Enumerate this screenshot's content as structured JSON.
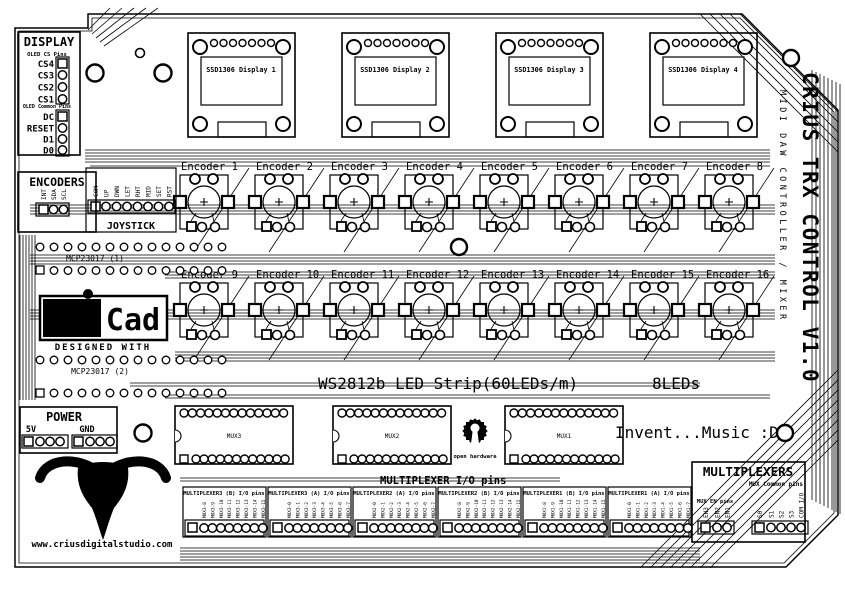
{
  "board": {
    "title_vertical": "CRIUS TRX CONTROL V1.0",
    "subtitle_vertical": "MIDI DAW CONTROLLER / MIXER",
    "website": "www.criusdigitalstudio.com",
    "slogan": "Invent...Music :D",
    "led_strip_label": "WS2812b LED Strip(60LEDs/m)",
    "led_count_label": "8LEDs",
    "skull_text": "CRIUS"
  },
  "display_block": {
    "title": "DISPLAY",
    "cs_section": "OLED CS Pins",
    "cs_pins": [
      "CS4",
      "CS3",
      "CS2",
      "CS1"
    ],
    "common_section": "OLED Common Pins",
    "common_pins": [
      "DC",
      "RESET",
      "D1",
      "D0"
    ]
  },
  "displays": [
    "SSD1306 Display 1",
    "SSD1306 Display 2",
    "SSD1306 Display 3",
    "SSD1306 Display 4"
  ],
  "encoders_block": {
    "title": "ENCODERS",
    "pins": [
      "INT",
      "SDA",
      "SCL"
    ]
  },
  "joystick": {
    "title": "JOYSTICK",
    "pins": [
      "COM",
      "UP",
      "DWN",
      "LET",
      "RHT",
      "MID",
      "SET",
      "RST"
    ]
  },
  "expanders": [
    "MCP23017 (1)",
    "MCP23017 (2)"
  ],
  "kicad": {
    "logo_left": "Ki",
    "logo_right": "Cad",
    "tagline": "DESIGNED WITH"
  },
  "encoders": [
    "Encoder 1",
    "Encoder 2",
    "Encoder 3",
    "Encoder 4",
    "Encoder 5",
    "Encoder 6",
    "Encoder 7",
    "Encoder 8",
    "Encoder 9",
    "Encoder 10",
    "Encoder 11",
    "Encoder 12",
    "Encoder 13",
    "Encoder 14",
    "Encoder 15",
    "Encoder 16"
  ],
  "power": {
    "title": "POWER",
    "pins": [
      "5V",
      "GND"
    ]
  },
  "mux_chips": [
    "MUX3",
    "MUX2",
    "MUX1"
  ],
  "mux_io_title": "MULTIPLEXER I/O pins",
  "mux_groups": [
    {
      "title": "MULTIPLEXER3 (B) I/O pins",
      "pins": [
        "MUX3-8",
        "MUX3-9",
        "MUX3-10",
        "MUX3-11",
        "MUX3-12",
        "MUX3-13",
        "MUX3-14",
        "MUX3-15"
      ]
    },
    {
      "title": "MULTIPLEXER3 (A) I/O pins",
      "pins": [
        "MUX3-0",
        "MUX3-1",
        "MUX3-2",
        "MUX3-3",
        "MUX3-4",
        "MUX3-5",
        "MUX3-6",
        "MUX3-7"
      ]
    },
    {
      "title": "MULTIPLEXER2 (A) I/O pins",
      "pins": [
        "MUX2-0",
        "MUX2-1",
        "MUX2-2",
        "MUX2-3",
        "MUX2-4",
        "MUX2-5",
        "MUX2-6",
        "MUX2-7"
      ]
    },
    {
      "title": "MULTIPLEXER2 (B) I/O pins",
      "pins": [
        "MUX2-8",
        "MUX2-9",
        "MUX2-10",
        "MUX2-11",
        "MUX2-12",
        "MUX2-13",
        "MUX2-14",
        "MUX2-15"
      ]
    },
    {
      "title": "MULTIPLEXER1 (B) I/O pins",
      "pins": [
        "MUX1-8",
        "MUX1-9",
        "MUX1-10",
        "MUX1-11",
        "MUX1-12",
        "MUX1-13",
        "MUX1-14",
        "MUX1-15"
      ]
    },
    {
      "title": "MULTIPLEXER1 (A) I/O pins",
      "pins": [
        "MUX1-0",
        "MUX1-1",
        "MUX1-2",
        "MUX1-3",
        "MUX1-4",
        "MUX1-5",
        "MUX1-6",
        "MUX1-7"
      ]
    }
  ],
  "multiplexers_block": {
    "title": "MULTIPLEXERS",
    "subtitle": "MUX Common pins",
    "en_label": "MUX EN pins",
    "en_pins": [
      "EN3",
      "EN2",
      "EN1"
    ],
    "common_pins": [
      "S0",
      "S1",
      "S2",
      "S3",
      "COM I/O"
    ]
  },
  "open_hardware": {
    "label": "open hardware"
  }
}
